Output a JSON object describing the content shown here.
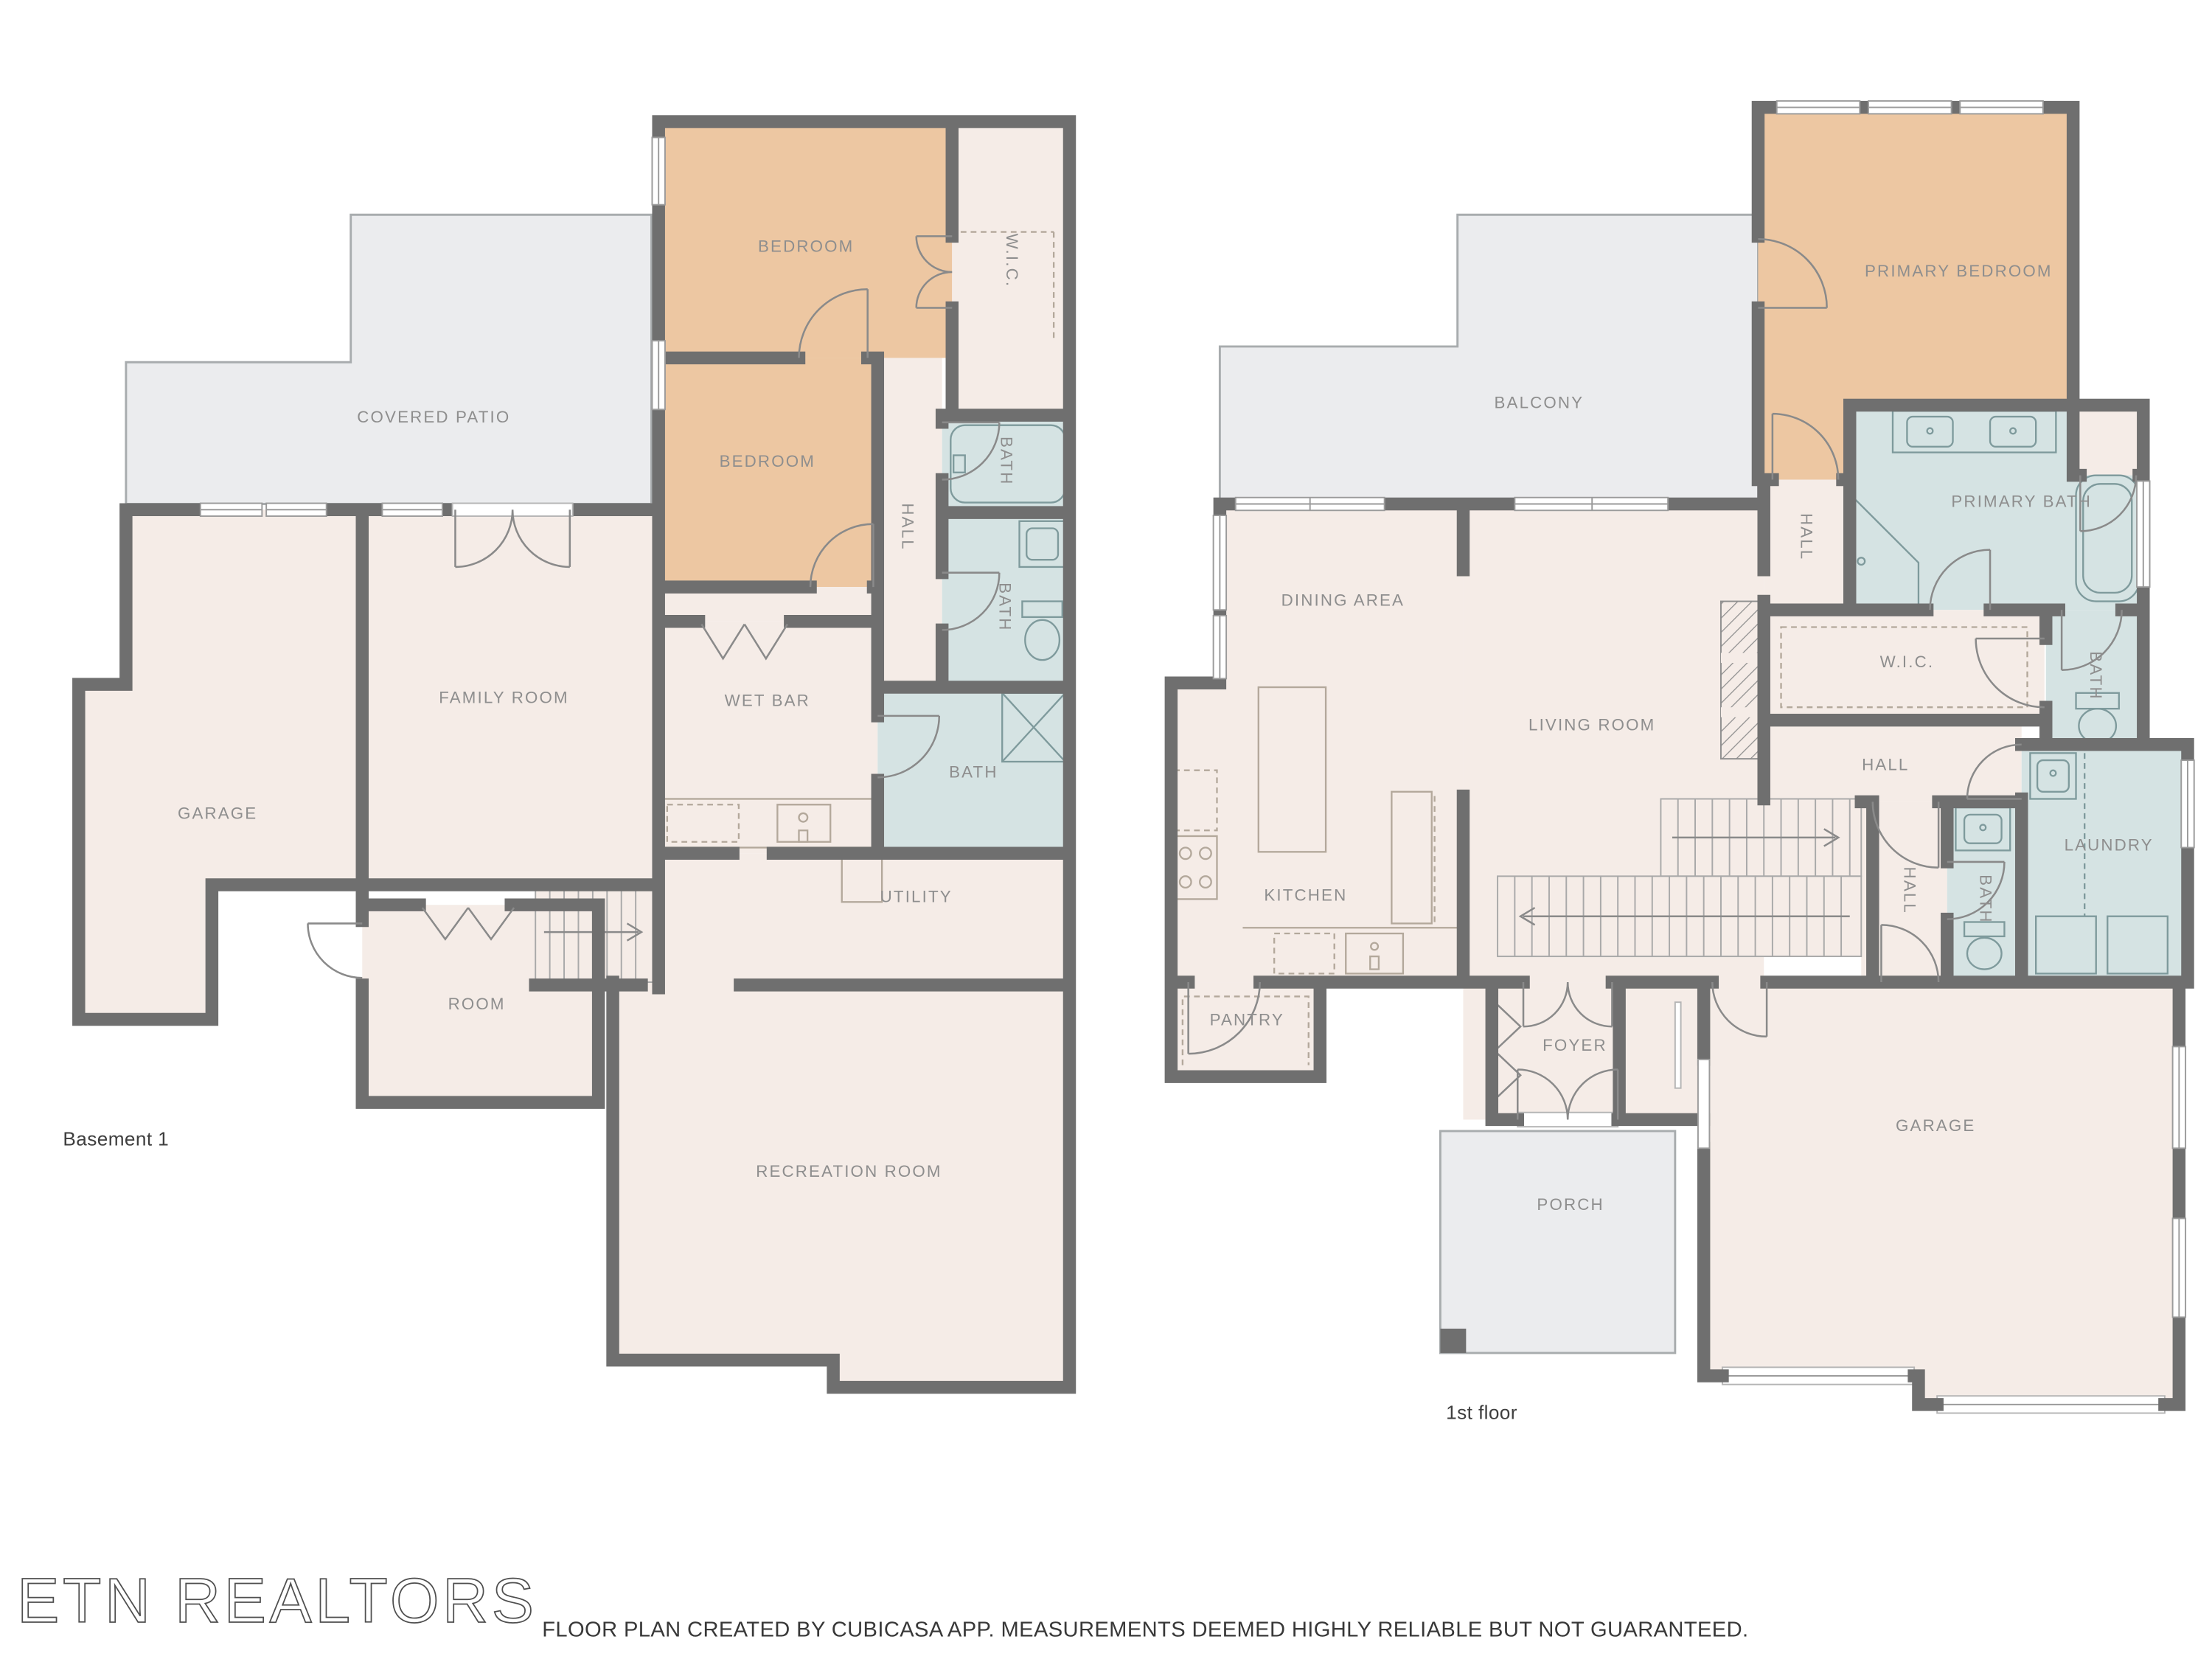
{
  "colors": {
    "wall": "#6f6f6f",
    "floor": "#f5ece7",
    "bedroom": "#edc7a2",
    "bath": "#d5e3e3",
    "outdoor": "#ebecee",
    "counter": "#f8f1ec",
    "label": "#8e8e8e"
  },
  "floors": [
    {
      "title": "Basement 1",
      "rooms": [
        {
          "id": "bedroom-1",
          "label": "BEDROOM"
        },
        {
          "id": "wic",
          "label": "W.I.C."
        },
        {
          "id": "bedroom-2",
          "label": "BEDROOM"
        },
        {
          "id": "bath-1",
          "label": "BATH"
        },
        {
          "id": "hall",
          "label": "HALL"
        },
        {
          "id": "bath-2",
          "label": "BATH"
        },
        {
          "id": "covered-patio",
          "label": "COVERED PATIO"
        },
        {
          "id": "family-room",
          "label": "FAMILY ROOM"
        },
        {
          "id": "wet-bar",
          "label": "WET BAR"
        },
        {
          "id": "garage",
          "label": "GARAGE"
        },
        {
          "id": "bath-3",
          "label": "BATH"
        },
        {
          "id": "utility",
          "label": "UTILITY"
        },
        {
          "id": "room",
          "label": "ROOM"
        },
        {
          "id": "recreation-room",
          "label": "RECREATION ROOM"
        }
      ]
    },
    {
      "title": "1st floor",
      "rooms": [
        {
          "id": "balcony",
          "label": "BALCONY"
        },
        {
          "id": "primary-bedroom",
          "label": "PRIMARY BEDROOM"
        },
        {
          "id": "primary-bath",
          "label": "PRIMARY BATH"
        },
        {
          "id": "hall-1",
          "label": "HALL"
        },
        {
          "id": "dining-area",
          "label": "DINING AREA"
        },
        {
          "id": "living-room",
          "label": "LIVING ROOM"
        },
        {
          "id": "wic",
          "label": "W.I.C."
        },
        {
          "id": "bath-1",
          "label": "BATH"
        },
        {
          "id": "hall-2",
          "label": "HALL"
        },
        {
          "id": "laundry",
          "label": "LAUNDRY"
        },
        {
          "id": "kitchen",
          "label": "KITCHEN"
        },
        {
          "id": "hall-3",
          "label": "HALL"
        },
        {
          "id": "bath-2",
          "label": "BATH"
        },
        {
          "id": "pantry",
          "label": "PANTRY"
        },
        {
          "id": "foyer",
          "label": "FOYER"
        },
        {
          "id": "porch",
          "label": "PORCH"
        },
        {
          "id": "garage",
          "label": "GARAGE"
        }
      ]
    }
  ],
  "footer": {
    "watermark": "ETN REALTORS",
    "disclaimer": "FLOOR PLAN CREATED BY CUBICASA APP. MEASUREMENTS DEEMED HIGHLY RELIABLE BUT NOT GUARANTEED."
  }
}
